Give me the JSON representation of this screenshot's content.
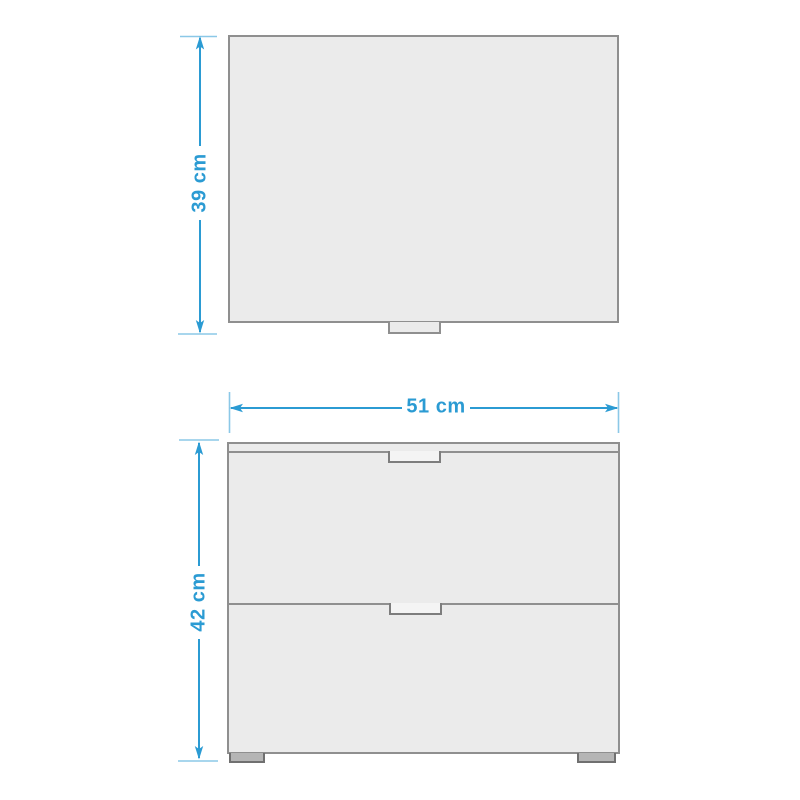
{
  "diagram": {
    "colors": {
      "accent": "#2b9bd3",
      "panel-fill": "#ebebeb",
      "panel-border": "#8f8f8f",
      "handle-fill": "#f4f4f4",
      "foot-fill": "#b5b5b5",
      "foot-border": "#707070",
      "canvas-bg": "#ffffff"
    },
    "dimensions": {
      "depth": {
        "label": "39 cm"
      },
      "width": {
        "label": "51 cm"
      },
      "height": {
        "label": "42 cm"
      }
    }
  }
}
